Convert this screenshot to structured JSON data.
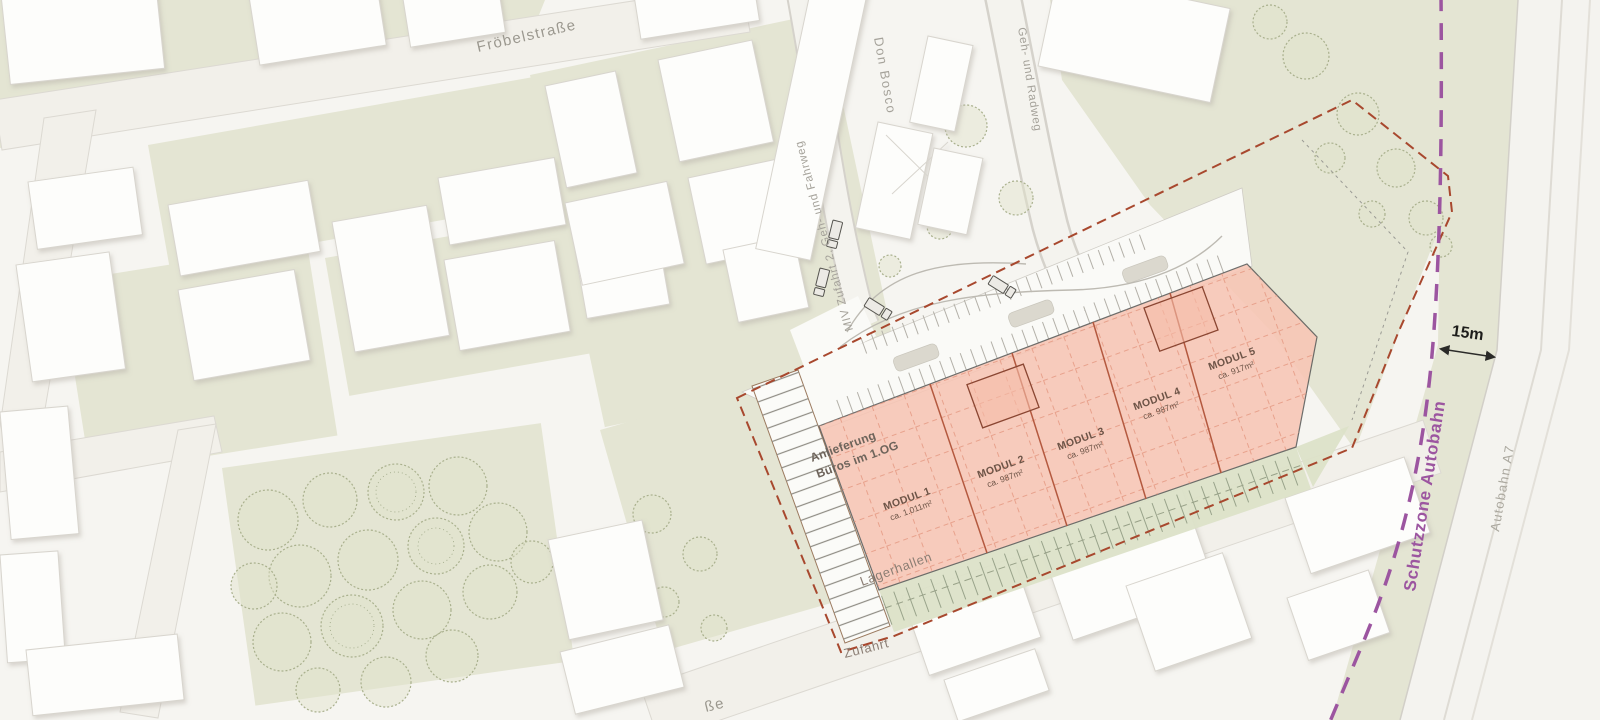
{
  "title": "Lageplan Lagerhallen-Projekt",
  "labels": {
    "froebelstrasse": "Fröbelstraße",
    "don_bosco": "Don Bosco",
    "geh_radweg": "Geh- und Radweg",
    "miv_zufahrt": "MIV Zufahrt 2, Geh- und Fahrweg",
    "schutzzone": "Schutzzone Autobahn",
    "autobahn": "Autobahn A7",
    "distance_15m": "15m",
    "zufahrt": "Zufahrt",
    "lagerhallen": "Lagerhallen",
    "anlieferung_line1": "Anlieferung",
    "anlieferung_line2": "Büros im 1.OG",
    "partial_street": "ße"
  },
  "site": {
    "modules": [
      {
        "name": "MODUL 1",
        "area": "ca. 1.011m²"
      },
      {
        "name": "MODUL 2",
        "area": "ca. 987m²"
      },
      {
        "name": "MODUL 3",
        "area": "ca. 987m²"
      },
      {
        "name": "MODUL 4",
        "area": "ca. 987m²"
      },
      {
        "name": "MODUL 5",
        "area": "ca. 917m²"
      }
    ]
  },
  "colors": {
    "hall_pink": "#f7c5b4",
    "grid_red": "#e2937c",
    "module_line": "#b4593f",
    "boundary_brown": "#a8482e",
    "schutzzone_purple": "#9c55a0",
    "green_area": "#e4e5d3",
    "landscape_strip": "#dce1c8"
  }
}
